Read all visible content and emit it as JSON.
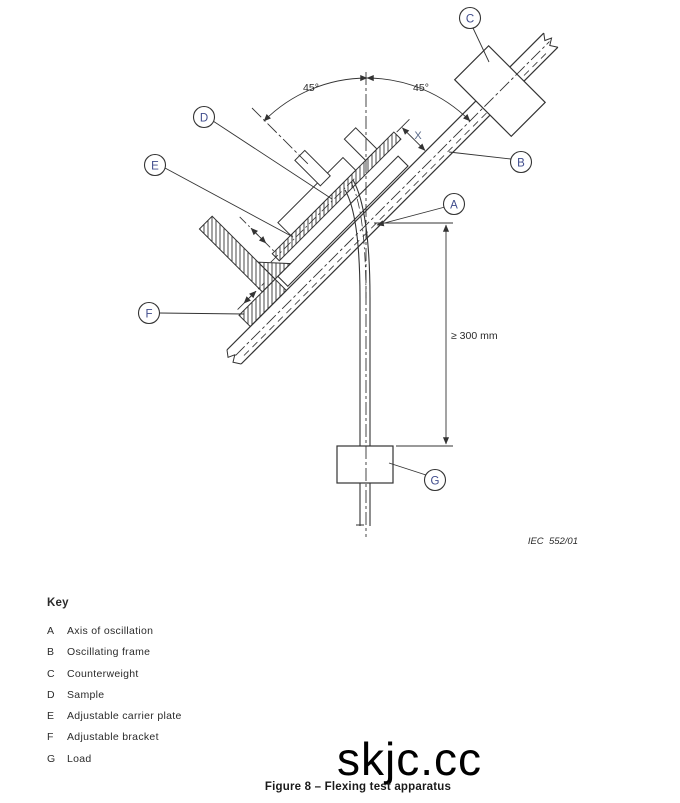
{
  "diagram": {
    "callouts": [
      "A",
      "B",
      "C",
      "D",
      "E",
      "F",
      "G"
    ],
    "angle_left_label": "45°",
    "angle_right_label": "45°",
    "x_dimension_label": "X",
    "min_hang_length_label": "≥ 300 mm",
    "figure_ref": "IEC  552/01"
  },
  "key": {
    "title": "Key",
    "items": [
      {
        "letter": "A",
        "label": "Axis of oscillation"
      },
      {
        "letter": "B",
        "label": "Oscillating frame"
      },
      {
        "letter": "C",
        "label": "Counterweight"
      },
      {
        "letter": "D",
        "label": "Sample"
      },
      {
        "letter": "E",
        "label": "Adjustable carrier plate"
      },
      {
        "letter": "F",
        "label": "Adjustable bracket"
      },
      {
        "letter": "G",
        "label": "Load"
      }
    ]
  },
  "watermark": "skjc.cc",
  "caption": "Figure 8 – Flexing test apparatus",
  "colors": {
    "line": "#333333",
    "callout_text": "#3f4c8c",
    "dim_text": "#5b6b8a",
    "text": "#2b2b2b"
  }
}
